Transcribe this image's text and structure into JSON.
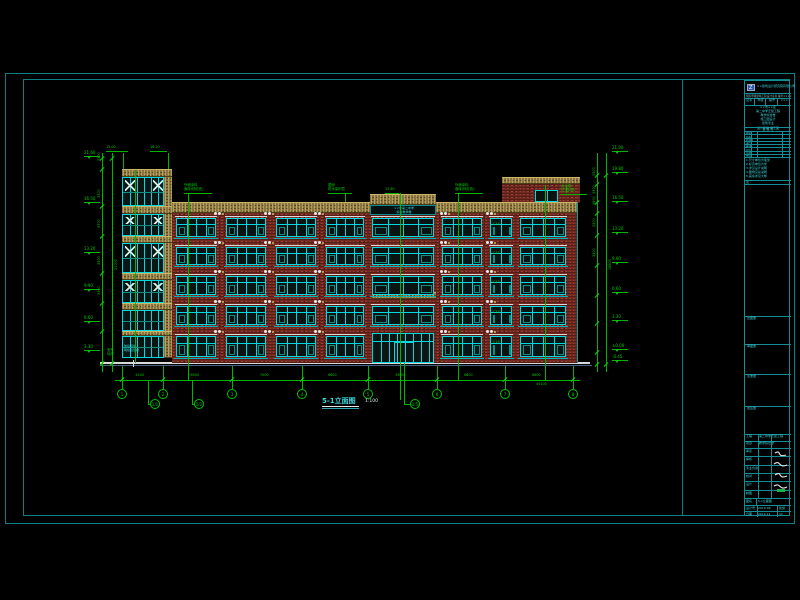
{
  "colors": {
    "background": "#000000",
    "frame": "#0d8084",
    "window_frame": "#00d9e2",
    "annotation_green": "#00c400",
    "brick": "#74281f",
    "spandrel": "#8a7440",
    "ground_white": "#d9d9d9"
  },
  "drawing_title": {
    "text": "5-1立面图",
    "scale": "1:100"
  },
  "annotations_top": [
    {
      "x": 106,
      "y": 146,
      "w": 22,
      "lines": [
        "15.00"
      ],
      "lx": 123,
      "ly1": 153,
      "ly2": 169
    },
    {
      "x": 150,
      "y": 146,
      "w": 17,
      "lines": [
        "16.20"
      ],
      "lx": 168,
      "ly1": 153,
      "ly2": 169
    },
    {
      "x": 184,
      "y": 184,
      "w": 28,
      "lines": [
        "外墙涂料",
        "面砖(棕红色)"
      ],
      "lx": 188,
      "ly1": 193,
      "ly2": 203
    },
    {
      "x": 328,
      "y": 184,
      "w": 24,
      "lines": [
        "屋面",
        "防水保护层"
      ],
      "lx": 345,
      "ly1": 193,
      "ly2": 202
    },
    {
      "x": 385,
      "y": 188,
      "w": 14,
      "lines": [
        "15.60"
      ],
      "lx": 400,
      "ly1": 193,
      "ly2": 196
    },
    {
      "x": 455,
      "y": 184,
      "w": 28,
      "lines": [
        "外墙涂料",
        "面砖(棕红色)"
      ],
      "lx": 458,
      "ly1": 193,
      "ly2": 203
    },
    {
      "x": 561,
      "y": 185,
      "w": 26,
      "lines": [
        "女儿墙",
        "压顶详图"
      ],
      "lx": 566,
      "ly1": 193,
      "ly2": 185
    }
  ],
  "markers_left": [
    {
      "y": 156,
      "v": "21.60"
    },
    {
      "y": 202,
      "v": "16.50"
    },
    {
      "y": 252,
      "v": "13.20"
    },
    {
      "y": 289,
      "v": "9.90"
    },
    {
      "y": 321,
      "v": "6.60"
    },
    {
      "y": 350,
      "v": "3.30"
    }
  ],
  "markers_right": [
    {
      "y": 151,
      "v": "21.90"
    },
    {
      "y": 172,
      "v": "19.80"
    },
    {
      "y": 201,
      "v": "16.50"
    },
    {
      "y": 232,
      "v": "13.20"
    },
    {
      "y": 262,
      "v": "9.90"
    },
    {
      "y": 292,
      "v": "6.60"
    },
    {
      "y": 320,
      "v": "3.30"
    },
    {
      "y": 349,
      "v": "±0.00"
    },
    {
      "y": 360,
      "v": "-0.45"
    }
  ],
  "chains": {
    "left": {
      "x_floor": 102,
      "x_total": 112,
      "ticks": [
        158,
        169,
        206,
        236,
        273,
        303,
        331,
        363
      ],
      "seg_labels": [
        "3300",
        "3300",
        "3300",
        "3300",
        "3300"
      ],
      "total": "21000"
    },
    "right": {
      "x_floor": 597,
      "x_total": 606,
      "ticks": [
        175,
        184,
        202,
        213,
        235,
        265,
        295,
        323,
        352,
        364
      ],
      "seg_labels": [
        "3300",
        "3300",
        "3300",
        "3300",
        "3300"
      ],
      "total": "19800"
    }
  },
  "grid": {
    "bubbles": [
      {
        "x": 122,
        "n": "1"
      },
      {
        "x": 163,
        "n": "2"
      },
      {
        "x": 232,
        "n": "3"
      },
      {
        "x": 302,
        "n": "4"
      },
      {
        "x": 368,
        "n": "5"
      },
      {
        "x": 437,
        "n": "6"
      },
      {
        "x": 505,
        "n": "7"
      },
      {
        "x": 573,
        "n": "8"
      }
    ],
    "dropped": [
      {
        "x": 155,
        "n": "1/1",
        "lx": 148,
        "ly1": 380
      },
      {
        "x": 199,
        "n": "1/2",
        "lx": 192,
        "ly1": 380
      },
      {
        "x": 415,
        "n": "1/5",
        "lx": 404,
        "ly1": 363
      }
    ],
    "vlines": [
      {
        "x": 135,
        "y1": 170,
        "y2": 363
      },
      {
        "x": 188,
        "y1": 196,
        "y2": 380
      },
      {
        "x": 400,
        "y1": 196,
        "y2": 400
      },
      {
        "x": 458,
        "y1": 197,
        "y2": 380
      },
      {
        "x": 545,
        "y1": 185,
        "y2": 380
      }
    ]
  },
  "dims": {
    "segments": [
      {
        "x1": 122,
        "x2": 163,
        "v": "4100"
      },
      {
        "x1": 163,
        "x2": 232,
        "v": "6900"
      },
      {
        "x1": 232,
        "x2": 302,
        "v": "7000"
      },
      {
        "x1": 302,
        "x2": 368,
        "v": "6600"
      },
      {
        "x1": 368,
        "x2": 437,
        "v": "6900"
      },
      {
        "x1": 437,
        "x2": 505,
        "v": "6800"
      },
      {
        "x1": 505,
        "x2": 573,
        "v": "6800"
      }
    ],
    "overall": "45100"
  },
  "tower": {
    "bands": [
      {
        "y": 169,
        "h": 8
      },
      {
        "y": 206,
        "h": 8
      },
      {
        "y": 236,
        "h": 7
      },
      {
        "y": 273,
        "h": 7
      },
      {
        "y": 303,
        "h": 7
      },
      {
        "y": 331,
        "h": 5
      }
    ],
    "strips": [
      {
        "y": 177,
        "h": 29
      },
      {
        "y": 214,
        "h": 22
      },
      {
        "y": 243,
        "h": 30
      },
      {
        "y": 280,
        "h": 23
      },
      {
        "y": 310,
        "h": 21
      },
      {
        "y": 336,
        "h": 22
      }
    ],
    "base_text": [
      "玻璃幕墙",
      "明框铝型材"
    ]
  },
  "facade": {
    "rows": [
      {
        "y": 218,
        "h": 19
      },
      {
        "y": 247,
        "h": 18
      },
      {
        "y": 276,
        "h": 19
      },
      {
        "y": 306,
        "h": 19
      },
      {
        "y": 336,
        "h": 21
      }
    ],
    "bays": [
      {
        "x": 176,
        "w": 40
      },
      {
        "x": 226,
        "w": 40
      },
      {
        "x": 276,
        "w": 40
      },
      {
        "x": 326,
        "w": 38
      },
      {
        "x": 372,
        "w": 62
      },
      {
        "x": 442,
        "w": 40
      },
      {
        "x": 490,
        "w": 22
      },
      {
        "x": 520,
        "w": 46
      }
    ],
    "window_code": "C15",
    "sign_lines": [
      "××市第二中学",
      "综合教学楼"
    ]
  },
  "site_label": [
    "室外",
    "地坪"
  ],
  "title_block": {
    "logo_text": "××建筑设计研究院有限公司",
    "logo_sub": "国家甲级建筑工程设计证书 编号××××",
    "cert_cells": [
      "证书",
      "甲级",
      "编号",
      "×××"
    ],
    "project_lines": [
      "××市××区",
      "第二中学迁建工程",
      "教学综合楼",
      "施工图设计",
      "建筑专业"
    ],
    "stage_line": "设计阶段 施工图",
    "sign_header": "会 签 栏",
    "sign_rows": [
      "建筑",
      "结构",
      "给排水",
      "电气",
      "暖通",
      "动力",
      "总图",
      "经济"
    ],
    "notes": [
      "1.尺寸单位为毫米",
      "2.标高单位为米",
      "3.详见设计说明",
      "4.图例见总说明",
      "5.其余详见大样"
    ],
    "sections": [
      "出图章",
      "审图章",
      "注册章",
      "会签章"
    ],
    "bottom_r1": [
      "工程",
      "第二中学迁建工程"
    ],
    "bottom_r2": [
      "项目",
      "教学综合楼"
    ],
    "roles": [
      "审定",
      "审核",
      "专业负责",
      "校对",
      "设计",
      "制图"
    ],
    "name_row": [
      "图名",
      "5-1立面图"
    ],
    "meta_rows": [
      [
        "设计号",
        "2010-08",
        "建施"
      ],
      [
        "日期",
        "2010.12",
        "12"
      ]
    ]
  }
}
